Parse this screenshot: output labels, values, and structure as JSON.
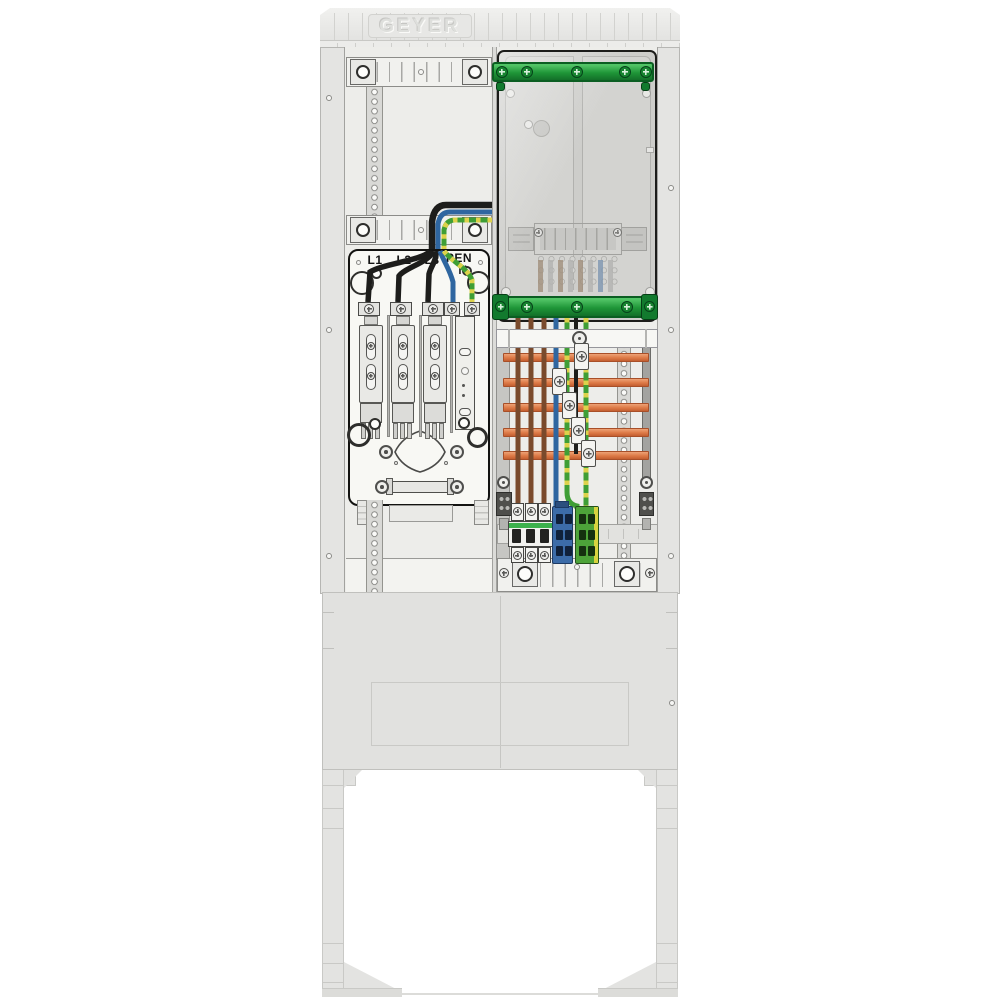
{
  "brand": {
    "logo_text": "GEYER"
  },
  "connection_box_labels": {
    "l1": "L1",
    "l2": "L2",
    "l3": "L3",
    "pen": "PEN",
    "n": "N"
  },
  "colors": {
    "cabinet_body_gray": "#e4e4e2",
    "meter_cover_gray": "#cfcfcc",
    "busbar_green": "#1f9638",
    "busbar_copper_orange": "#dd7946",
    "wire_black": "#1d1d1b",
    "wire_blue": "#2f66a0",
    "wire_brown": "#7a4a2c",
    "wire_green": "#3f9e35",
    "wire_yellow_stripe": "#ddd24b",
    "neutral_terminal_blue": "#3c6ca8",
    "pe_terminal_green": "#4da339",
    "breaker_strip_green": "#3cb14d"
  },
  "icons": {
    "screw": "cross-head-screw",
    "mounting_hole": "round-hole",
    "busbar_clamp": "tap-clamp"
  }
}
